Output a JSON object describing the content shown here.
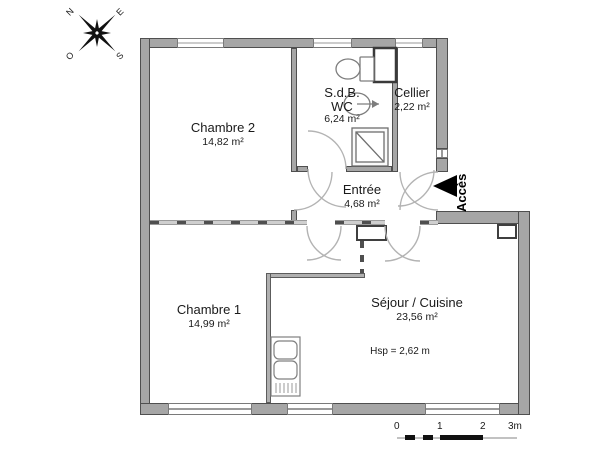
{
  "plan": {
    "rooms": [
      {
        "name": "Chambre 2",
        "area": "14,82 m²"
      },
      {
        "name": "S.d.B.",
        "name2": "WC",
        "area": "6,24 m²"
      },
      {
        "name": "Cellier",
        "area": "2,22 m²"
      },
      {
        "name": "Entrée",
        "area": "4,68 m²"
      },
      {
        "name": "Chambre 1",
        "area": "14,99 m²"
      },
      {
        "name": "Séjour / Cuisine",
        "area": "23,56 m²",
        "note": "Hsp = 2,62 m"
      }
    ],
    "access": {
      "label": "Accès"
    },
    "compass": {
      "n": "N",
      "e": "E",
      "s": "S",
      "o": "O"
    },
    "scalebar": {
      "t0": "0",
      "t1": "1",
      "t2": "2",
      "t3": "3m"
    },
    "colors": {
      "wall_fill": "#a6a6a6",
      "wall_stroke": "#4f4f4f",
      "door_arc": "#b3b3b3",
      "fixture_stroke": "#7d7d7d",
      "text": "#1a1a1a",
      "black": "#000000"
    }
  }
}
